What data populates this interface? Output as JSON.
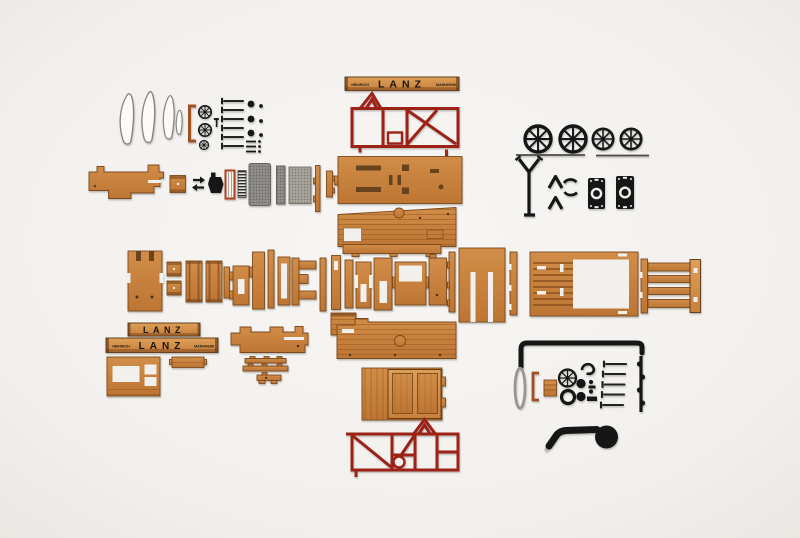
{
  "scene": {
    "type": "photograph",
    "description": "Flat-lay studio photo of an unassembled LANZ tractor wooden model kit: laser-cut wooden panels, red painted chassis frames, black metal wheels and fittings arranged in rows on a white background.",
    "background_color": "#f3f1ee"
  },
  "branding": {
    "lanz": "LANZ",
    "heinrich": "HEINRICH",
    "mannheim": "MANNHEIM"
  },
  "colors": {
    "wood": "#c7823f",
    "wood_light": "#d89a52",
    "wood_edge": "#7c4a1c",
    "chassis_red": "#9c2015",
    "metal_black": "#161616",
    "mesh_gray": "#928f8b",
    "bracket_copper": "#a05122",
    "white_part": "#fcfbf9"
  },
  "parts_inventory": [
    "white-fender-templates",
    "copper-bracket-small",
    "small-spoked-gears",
    "screw-set-a",
    "rivet-and-pin-set",
    "nameplate-beam-top",
    "red-chassis-frame-a",
    "spoked-wheels",
    "wheel-axle-rods",
    "steering-column",
    "v-spring-clips",
    "s-spring-clips",
    "gearbox-plates",
    "hood-side-panel-a",
    "toolbox-block",
    "assembly-arrows",
    "exhaust-pot",
    "radiator-frame",
    "radiator-grille",
    "mesh-screens",
    "trim-strips",
    "cargo-floor-plate",
    "planked-side-panel-a",
    "front-axle-plate",
    "mounting-blocks",
    "crate-side-panels",
    "spacer-strip",
    "slotted-bracket",
    "support-piece",
    "pillar-strip",
    "frame-loop",
    "clamp-piece",
    "top-rail-strip",
    "pillar-strip-set",
    "h-bracket",
    "slotted-panel",
    "window-bracket",
    "backrest-panel",
    "side-strip",
    "seat-back-panel",
    "notched-strip",
    "slatted-bed-frame",
    "side-rail-strip",
    "ladder-rack",
    "nameplate-beam-small",
    "nameplate-beam-large",
    "cab-front-panel",
    "roof-plank",
    "hood-side-panel-b",
    "axle-strips",
    "engine-bracket",
    "slat-block",
    "planked-side-panel-b",
    "door-panel",
    "red-chassis-frame-b",
    "front-axle-rod",
    "steering-wheel-rim",
    "copper-bracket-b",
    "wood-block-small",
    "flywheel",
    "o-ring",
    "spring-hook",
    "rivet-set-b",
    "screw-set-b",
    "crankshaft-bar",
    "exhaust-muffler"
  ]
}
